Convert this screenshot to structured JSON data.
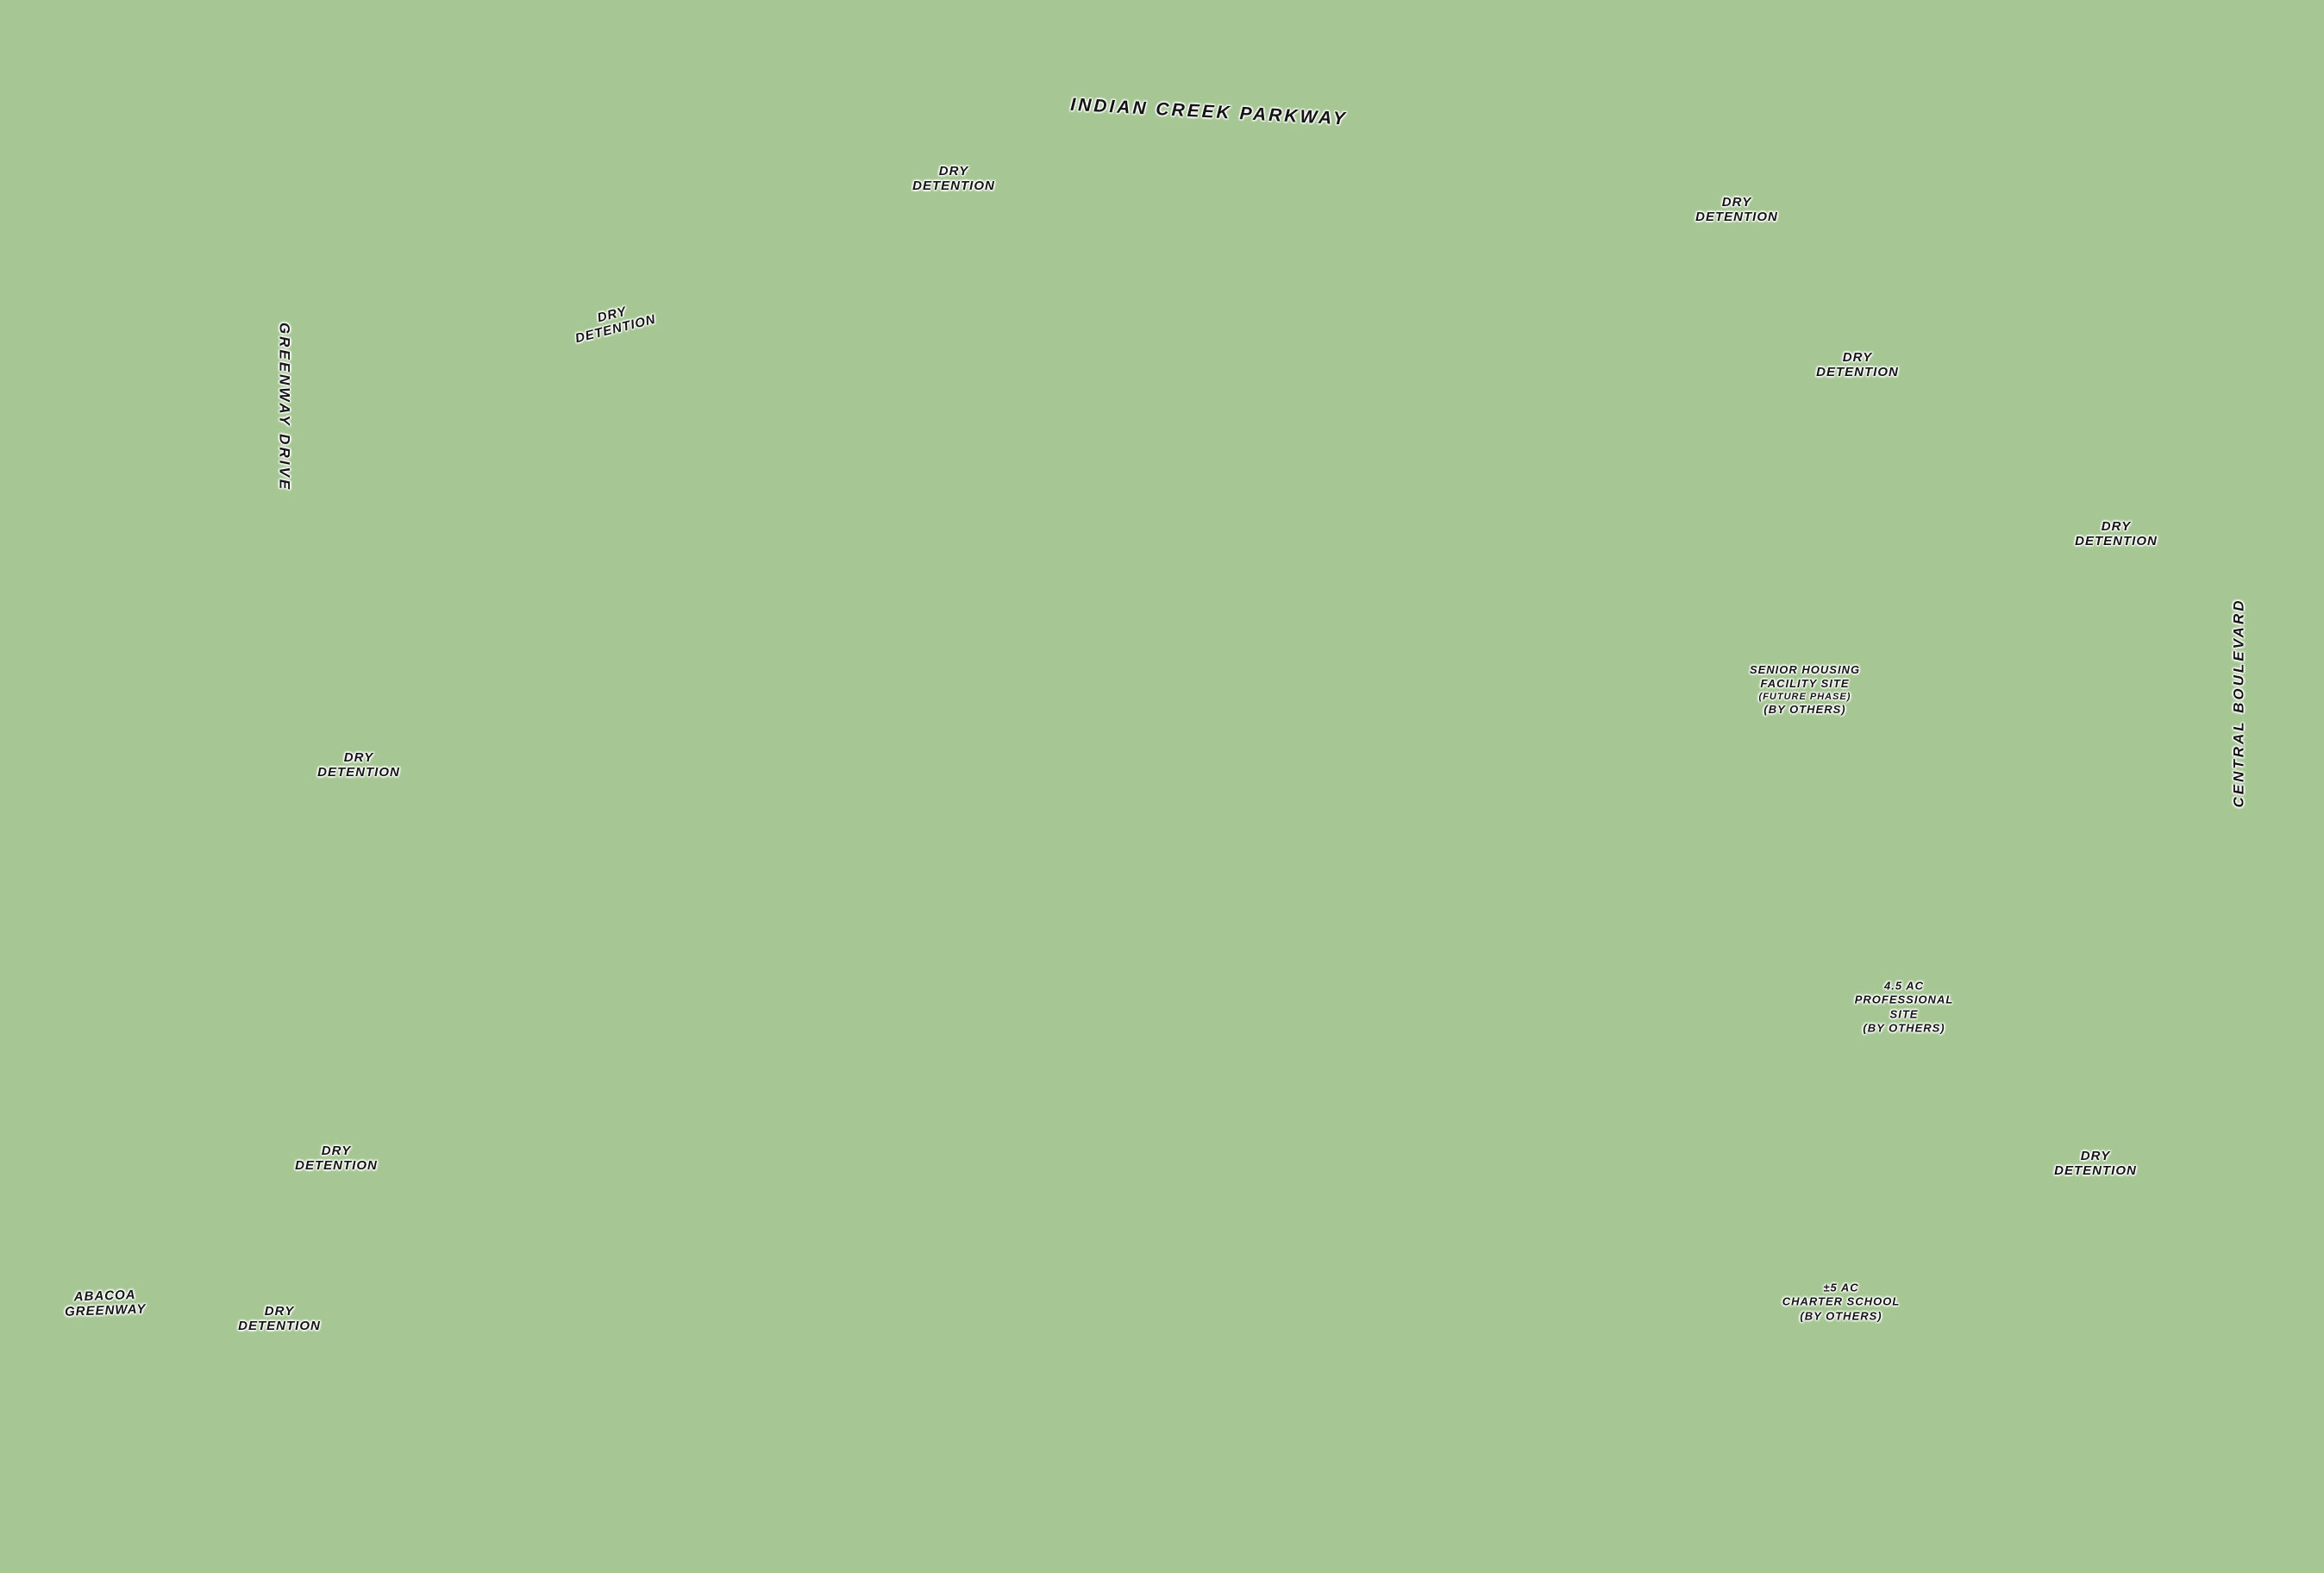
{
  "map": {
    "streets": {
      "indian_creek_parkway": "INDIAN CREEK PARKWAY",
      "greenway_drive": "GREENWAY DRIVE",
      "central_boulevard": "CENTRAL BOULEVARD"
    },
    "areas": {
      "dry_detention": "DRY DETENTION",
      "abacoa_greenway": "ABACOA GREENWAY"
    },
    "sites": {
      "senior_housing": {
        "lines": [
          "SENIOR HOUSING",
          "FACILITY SITE",
          "(FUTURE PHASE)",
          "(BY OTHERS)"
        ]
      },
      "professional": {
        "lines": [
          "4.5 AC",
          "PROFESSIONAL",
          "SITE",
          "(BY OTHERS)"
        ]
      },
      "charter_school": {
        "lines": [
          "±5 AC",
          "CHARTER SCHOOL",
          "(BY OTHERS)"
        ]
      }
    },
    "colors": {
      "background_green": "#a6c794",
      "lot_green": "#bdd7a8",
      "road_tan": "#d8d4c6",
      "forest_green": "#557f49",
      "lot_tag_red": "#d22a24",
      "tag_blue": "#2b3db5",
      "tag_yellow": "#e5d043",
      "pool_blue": "#74c6e4",
      "roof_brown": "#a97353",
      "roof_gray": "#9a9a9a"
    }
  }
}
